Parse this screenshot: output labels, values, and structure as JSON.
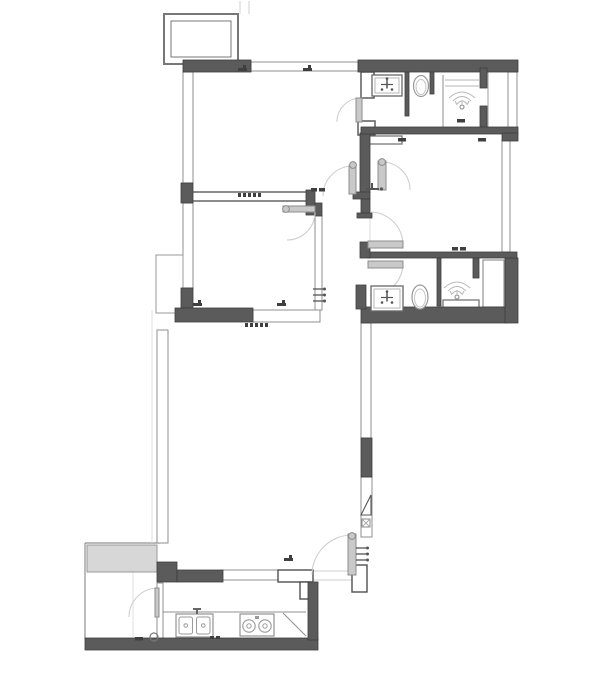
{
  "canvas": {
    "width": 600,
    "height": 679,
    "background": "#ffffff"
  },
  "colors": {
    "wall_fill": "#5b5b5b",
    "wall_stroke": "#3e3e3e",
    "outline": "#4f4f4f",
    "thin": "#8f8f8f",
    "faint": "#d9d9d9",
    "leaf": "#c9c9c9",
    "leaf_stroke": "#8d8d8d",
    "arc": "#cfcfcf",
    "fixture": "#9a9a9a",
    "fixture_light": "#b8b8b8",
    "fixture_dark": "#555555",
    "symbol": "#3f3f3f",
    "shade": "#d7d7d7"
  },
  "plan": {
    "walls_filled": [
      {
        "n": "wall-balcony-top",
        "r": [
          183,
          60,
          68,
          12
        ]
      },
      {
        "n": "wall-top-right",
        "r": [
          358,
          60,
          160,
          12
        ]
      },
      {
        "n": "wall-left-block-upper",
        "r": [
          181,
          183,
          12,
          20
        ]
      },
      {
        "n": "wall-left-block-lower",
        "r": [
          181,
          288,
          12,
          20
        ]
      },
      {
        "n": "wall-bedroom2-bottom",
        "r": [
          175,
          308,
          78,
          14
        ]
      },
      {
        "n": "wall-bath2-bottom",
        "r": [
          361,
          307,
          146,
          16
        ]
      },
      {
        "n": "wall-bath2-right",
        "r": [
          505,
          258,
          13,
          65
        ]
      },
      {
        "n": "wall-living-right-seg",
        "r": [
          361,
          438,
          11,
          39
        ]
      },
      {
        "n": "wall-kitchen-step",
        "r": [
          157,
          562,
          20,
          20
        ]
      },
      {
        "n": "wall-kitchen-bar",
        "r": [
          177,
          570,
          46,
          12
        ]
      },
      {
        "n": "wall-bottom",
        "r": [
          85,
          638,
          233,
          12
        ]
      },
      {
        "n": "wall-kitchen-right",
        "r": [
          308,
          582,
          10,
          58
        ]
      },
      {
        "n": "wall-hall-vertical",
        "r": [
          360,
          133,
          10,
          60
        ]
      },
      {
        "n": "wall-hall-zig-a",
        "r": [
          353,
          192,
          17,
          7
        ]
      },
      {
        "n": "wall-hall-zig-b",
        "r": [
          361,
          199,
          9,
          14
        ]
      },
      {
        "n": "wall-hall-zig-c",
        "r": [
          357,
          213,
          15,
          5
        ]
      },
      {
        "n": "wall-hall-step",
        "r": [
          306,
          190,
          9,
          25
        ]
      },
      {
        "n": "wall-hall-step2",
        "r": [
          315,
          203,
          7,
          13
        ]
      },
      {
        "n": "wall-bedroom3-bottom",
        "r": [
          368,
          252,
          149,
          6
        ]
      },
      {
        "n": "wall-shower1-stub-a",
        "r": [
          480,
          68,
          7,
          20
        ]
      },
      {
        "n": "wall-shower1-stub-b",
        "r": [
          480,
          106,
          7,
          27
        ]
      },
      {
        "n": "wall-bath1-div-a",
        "r": [
          405,
          72,
          4,
          44
        ]
      },
      {
        "n": "wall-bath1-div-b",
        "r": [
          430,
          72,
          4,
          22
        ]
      },
      {
        "n": "wall-bath2-div",
        "r": [
          437,
          258,
          4,
          48
        ]
      },
      {
        "n": "wall-bath2-stub",
        "r": [
          473,
          258,
          6,
          20
        ]
      },
      {
        "n": "wall-hall-bracket",
        "r": [
          360,
          242,
          10,
          16
        ]
      },
      {
        "n": "wall-bath1-bottom",
        "r": [
          361,
          127,
          157,
          7
        ]
      },
      {
        "n": "wall-bath2-left-block",
        "r": [
          356,
          285,
          10,
          24
        ]
      },
      {
        "n": "wall-right-jog",
        "r": [
          502,
          133,
          16,
          8
        ]
      }
    ],
    "walls_outlined": [
      {
        "n": "balcony-outer",
        "r": [
          164,
          14,
          74,
          50
        ],
        "sw": 2,
        "sc": "#777777"
      },
      {
        "n": "balcony-inner",
        "r": [
          171,
          21,
          60,
          36
        ],
        "sw": 1,
        "sc": "#777777"
      },
      {
        "n": "bath1-left-stub",
        "r": [
          361,
          72,
          13,
          26
        ],
        "sw": 1.4,
        "sc": "#4f4f4f"
      },
      {
        "n": "bath1-step-piece",
        "r": [
          358,
          121,
          17,
          14
        ],
        "sw": 1.4,
        "sc": "#4f4f4f"
      },
      {
        "n": "bath1-inner-step",
        "r": [
          367,
          136,
          35,
          8
        ],
        "sw": 1.2,
        "sc": "#6a6a6a"
      },
      {
        "n": "bedroom1-bottom-band",
        "r": [
          183,
          192,
          124,
          9
        ],
        "sw": 1.3,
        "sc": "#4f4f4f"
      },
      {
        "n": "left-shaft",
        "r": [
          156,
          255,
          27,
          58
        ],
        "sw": 1,
        "sc": "#9a9a9a"
      },
      {
        "n": "entry-west-piece",
        "r": [
          278,
          570,
          35,
          12
        ],
        "sw": 1.4,
        "sc": "#4f4f4f"
      },
      {
        "n": "entry-west-hook",
        "r": [
          300,
          582,
          10,
          17
        ],
        "sw": 1.4,
        "sc": "#4f4f4f"
      },
      {
        "n": "entry-east-piece",
        "r": [
          352,
          565,
          15,
          27
        ],
        "sw": 1.4,
        "sc": "#4f4f4f"
      },
      {
        "n": "shower2-curb",
        "r": [
          443,
          300,
          36,
          11
        ],
        "sw": 1.2,
        "sc": "#6a6a6a"
      },
      {
        "n": "bath2-alcove",
        "r": [
          483,
          260,
          21,
          47
        ],
        "sw": 1.1,
        "sc": "#8a8a8a"
      },
      {
        "n": "utility-shade",
        "r": [
          87,
          545,
          70,
          27
        ],
        "sw": 1,
        "sc": "#999999",
        "fill": "#d7d7d7"
      }
    ],
    "windows": [
      {
        "n": "window-top",
        "r": [
          251,
          62,
          107,
          9
        ]
      },
      {
        "n": "window-left-upper",
        "r": [
          183,
          72,
          10,
          111
        ]
      },
      {
        "n": "window-left-mid",
        "r": [
          183,
          203,
          10,
          85
        ]
      },
      {
        "n": "window-bedroom2-bottom",
        "r": [
          253,
          310,
          67,
          12
        ]
      },
      {
        "n": "window-bedroom2-right",
        "r": [
          315,
          215,
          7,
          95
        ]
      },
      {
        "n": "window-bedroom3-right",
        "r": [
          502,
          140,
          8,
          112
        ]
      },
      {
        "n": "window-topright-side",
        "r": [
          508,
          72,
          9,
          56
        ]
      },
      {
        "n": "window-living-right",
        "r": [
          361,
          323,
          10,
          115
        ]
      },
      {
        "n": "window-living-left",
        "r": [
          157,
          330,
          11,
          213
        ]
      },
      {
        "n": "window-kitchen",
        "r": [
          222,
          570,
          56,
          10
        ]
      },
      {
        "n": "window-utility-divider",
        "r": [
          157,
          583,
          6,
          57
        ]
      },
      {
        "n": "window-living-right-lower",
        "r": [
          361,
          477,
          11,
          60
        ]
      }
    ],
    "lines": [
      {
        "n": "utility-top-line",
        "p": [
          85,
          543,
          160,
          543
        ],
        "c": "#8f8f8f",
        "w": 1.2
      },
      {
        "n": "utility-left-line",
        "p": [
          85,
          543,
          85,
          639
        ],
        "c": "#8f8f8f",
        "w": 1.2
      },
      {
        "n": "counter-top-line",
        "p": [
          163,
          612,
          306,
          612
        ],
        "c": "#8f8f8f",
        "w": 1
      },
      {
        "n": "counter-diagonal",
        "p": [
          283,
          613,
          306,
          636
        ],
        "c": "#8f8f8f",
        "w": 1
      },
      {
        "n": "shower1-wall-line",
        "p": [
          443,
          75,
          443,
          128
        ],
        "c": "#9f9f9f",
        "w": 1.2
      },
      {
        "n": "shower1-ledge-a",
        "p": [
          445,
          80,
          479,
          80
        ],
        "c": "#b5b5b5",
        "w": 1
      },
      {
        "n": "shower1-ledge-b",
        "p": [
          445,
          86,
          479,
          86
        ],
        "c": "#b5b5b5",
        "w": 1
      },
      {
        "n": "shaft1-line",
        "p": [
          488,
          72,
          488,
          127
        ],
        "c": "#9f9f9f",
        "w": 1
      },
      {
        "n": "threshold-a",
        "p": [
          313,
          571,
          352,
          571
        ],
        "c": "#cfcfcf",
        "w": 1
      },
      {
        "n": "threshold-b",
        "p": [
          313,
          580,
          352,
          580
        ],
        "c": "#cfcfcf",
        "w": 1
      },
      {
        "n": "guide-left",
        "p": [
          152,
          310,
          152,
          543
        ],
        "c": "#dedede",
        "w": 1
      },
      {
        "n": "guide-bottomleft",
        "p": [
          133,
          547,
          133,
          637
        ],
        "c": "#e2e2e2",
        "w": 1
      },
      {
        "n": "balcony-stub-a",
        "p": [
          240,
          1,
          240,
          14
        ],
        "c": "#cfcfcf",
        "w": 1
      },
      {
        "n": "balcony-stub-b",
        "p": [
          249,
          1,
          249,
          14
        ],
        "c": "#cfcfcf",
        "w": 1
      },
      {
        "n": "hall-guide",
        "p": [
          370,
          218,
          370,
          242
        ],
        "c": "#dddddd",
        "w": 1
      },
      {
        "n": "alcove-inner-line",
        "p": [
          487,
          262,
          487,
          305
        ],
        "c": "#b0b0b0",
        "w": 1
      }
    ],
    "doors": [
      {
        "n": "door-bedroom1",
        "arc": "M353,166 A30,30 0 0 0 323,196",
        "leaf": [
          349,
          166,
          7,
          28
        ],
        "hinge": [
          353,
          165
        ]
      },
      {
        "n": "door-bedroom2",
        "arc": "M315,212 A28,28 0 0 1 287,240",
        "leaf": [
          283,
          206,
          32,
          6
        ],
        "hinge": [
          286,
          209
        ]
      },
      {
        "n": "door-bedroom3",
        "arc": "M382,162 A28,28 0 0 1 410,190",
        "leaf": [
          378,
          161,
          8,
          29
        ],
        "hinge": [
          382,
          162
        ]
      },
      {
        "n": "door-closet",
        "arc": "M403,245 A33,33 0 0 0 370,212",
        "leaf": [
          368,
          241,
          35,
          7
        ]
      },
      {
        "n": "door-bath2",
        "arc": "M403,263 A33,33 0 0 1 370,296",
        "leaf": [
          368,
          261,
          35,
          7
        ]
      },
      {
        "n": "door-entry",
        "arc": "M352,535 A40,40 0 0 0 312,575",
        "leaf": [
          348,
          534,
          8,
          41
        ],
        "hinge": [
          352,
          536
        ]
      },
      {
        "n": "door-utility",
        "arc": "M158,588 A29,29 0 0 0 129,617",
        "leaf": [
          155,
          588,
          4,
          29
        ]
      },
      {
        "n": "door-bath1",
        "arc": "M361,98 A24,24 0 0 0 337,122",
        "leaf": [
          356,
          98,
          6,
          24
        ]
      }
    ],
    "fixtures": [
      {
        "t": "sink",
        "n": "bath1-sink",
        "r": [
          372,
          75,
          30,
          21
        ]
      },
      {
        "t": "toilet",
        "n": "bath1-toilet",
        "c": [
          421,
          86
        ],
        "rx": 7.5,
        "ry": 10.5
      },
      {
        "t": "shower",
        "n": "bath1-shower",
        "c": [
          462,
          97
        ]
      },
      {
        "t": "sink",
        "n": "bath2-sink",
        "r": [
          371,
          286,
          32,
          25
        ]
      },
      {
        "t": "toilet",
        "n": "bath2-toilet",
        "c": [
          420,
          297
        ],
        "rx": 8,
        "ry": 12
      },
      {
        "t": "shower",
        "n": "bath2-shower",
        "c": [
          457,
          287
        ]
      },
      {
        "t": "kitchen-sink",
        "n": "kitchen-sink",
        "r": [
          176,
          614,
          37,
          23
        ]
      },
      {
        "t": "stove",
        "n": "stove",
        "r": [
          240,
          614,
          34,
          22
        ]
      }
    ],
    "symbols": [
      {
        "t": "flag",
        "n": "wall-mark",
        "p": [
          238,
          66
        ]
      },
      {
        "t": "flag",
        "n": "wall-mark",
        "p": [
          303,
          66
        ]
      },
      {
        "t": "flag",
        "n": "wall-mark",
        "p": [
          193,
          301
        ]
      },
      {
        "t": "flag",
        "n": "wall-mark",
        "p": [
          277,
          301
        ]
      },
      {
        "t": "flag",
        "n": "wall-mark",
        "p": [
          284,
          556
        ]
      },
      {
        "t": "hatch",
        "n": "track-hatch",
        "p": [
          238,
          193
        ]
      },
      {
        "t": "hatch",
        "n": "track-hatch",
        "p": [
          245,
          323
        ]
      },
      {
        "t": "eq",
        "n": "double-mark",
        "p": [
          452,
          247
        ]
      },
      {
        "t": "eq",
        "n": "double-mark",
        "p": [
          311,
          188
        ]
      },
      {
        "t": "dash",
        "n": "wall-tick",
        "p": [
          457,
          119
        ]
      },
      {
        "t": "dash",
        "n": "wall-tick",
        "p": [
          398,
          138
        ]
      },
      {
        "t": "dash",
        "n": "wall-tick",
        "p": [
          478,
          138
        ]
      },
      {
        "t": "tee",
        "n": "tee-mark",
        "p": [
          366,
          185
        ]
      },
      {
        "t": "ticks3",
        "n": "triple-tick",
        "p": [
          313,
          289
        ]
      },
      {
        "t": "ticks3",
        "n": "triple-tick",
        "p": [
          356,
          548
        ]
      },
      {
        "t": "tri-panel",
        "n": "panel-symbol",
        "p": [
          361,
          495
        ]
      },
      {
        "t": "dots2",
        "n": "dot-pair",
        "p": [
          210,
          636
        ]
      },
      {
        "t": "circle",
        "n": "floor-drain",
        "p": [
          150,
          633
        ]
      },
      {
        "t": "dash",
        "n": "wall-tick",
        "p": [
          135,
          637
        ]
      },
      {
        "t": "faucet-mark",
        "n": "kitchen-faucet",
        "p": [
          196,
          608
        ]
      }
    ]
  }
}
